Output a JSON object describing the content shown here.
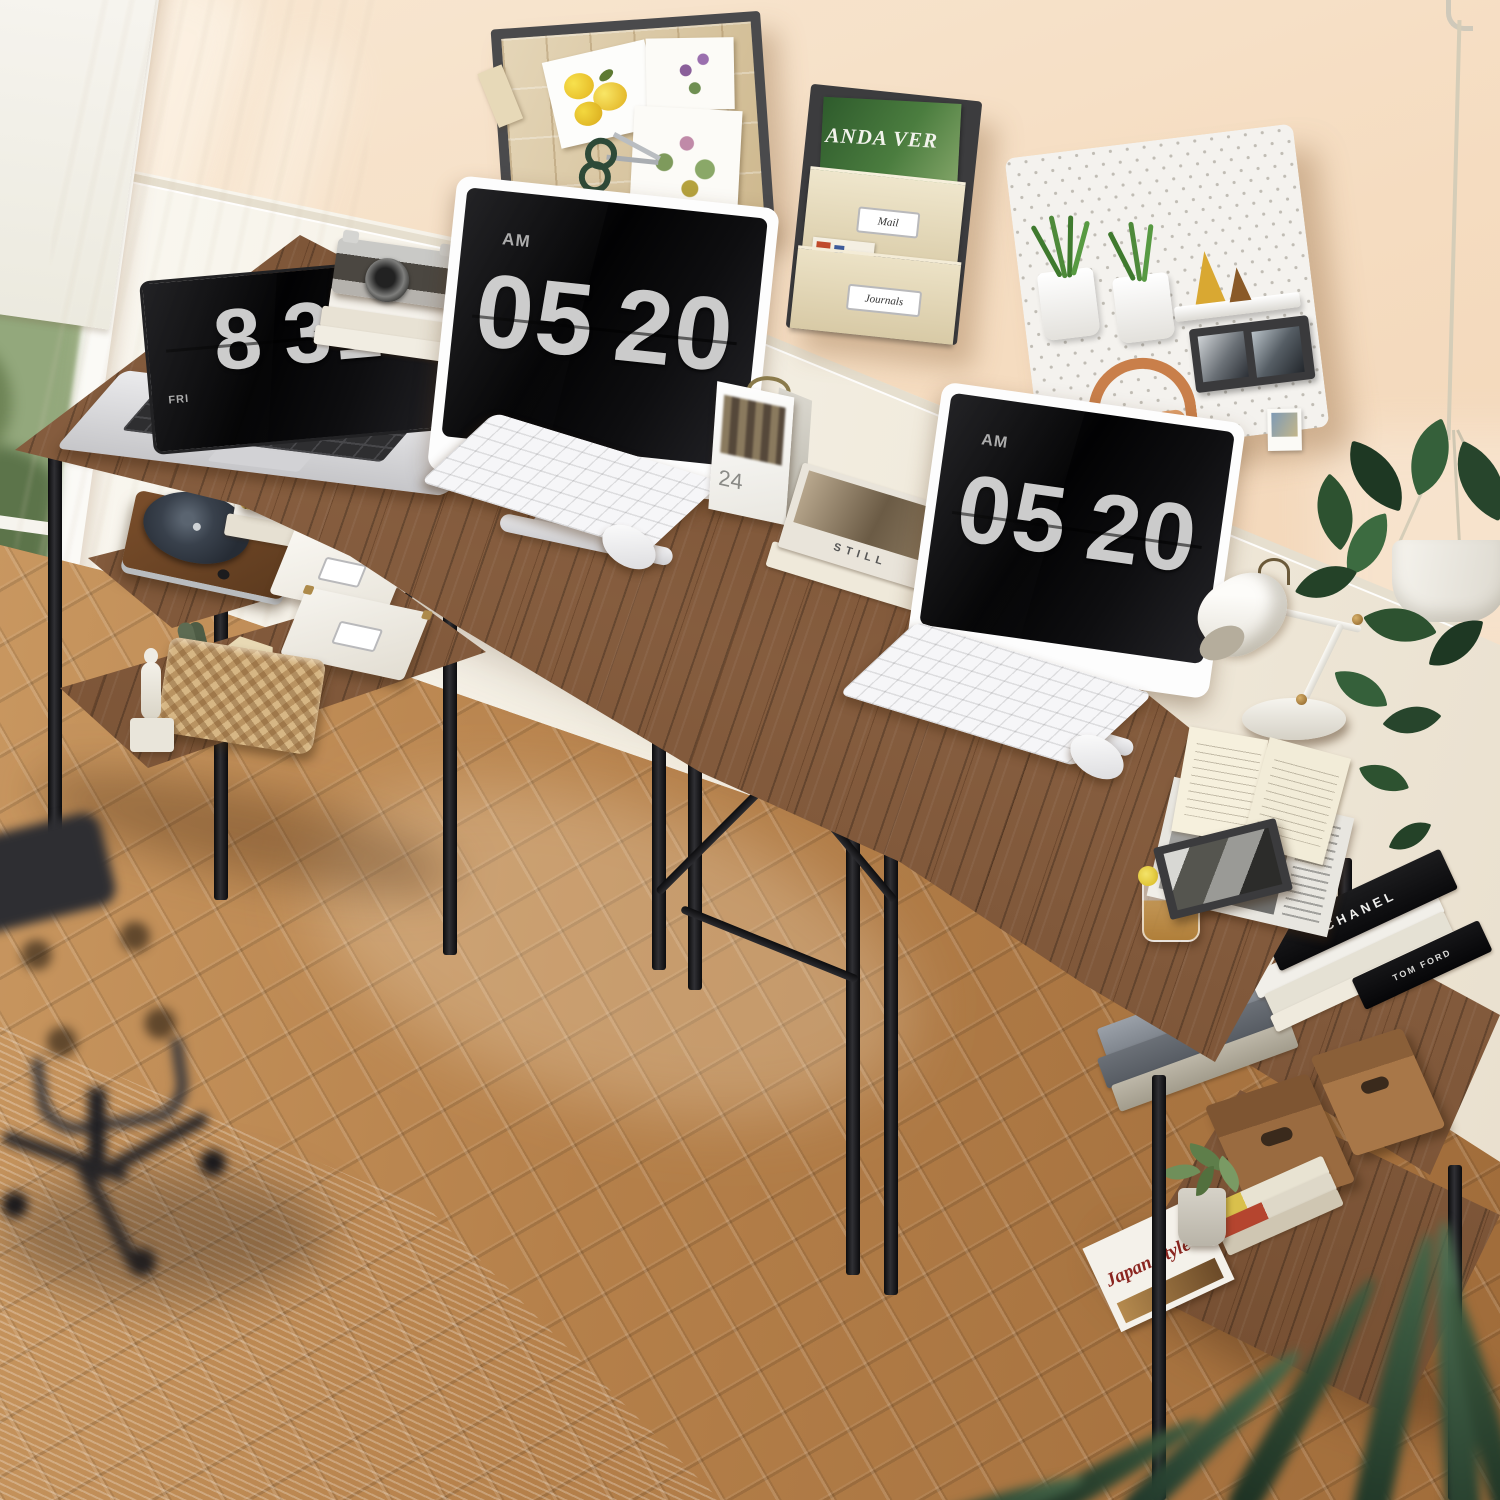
{
  "scene_title": "Rustic brown L-shaped double workstation desk with shelves in sunlit home office",
  "clocks": {
    "laptop": {
      "label": "FRI",
      "hour": "8",
      "minute": "31"
    },
    "monitor_left": {
      "meridiem": "AM",
      "hour": "05",
      "minute": "20"
    },
    "monitor_right": {
      "meridiem": "AM",
      "hour": "05",
      "minute": "20"
    }
  },
  "calendar": {
    "day": "24"
  },
  "wall_organizer": {
    "magazine_title": "ANDA VER",
    "pocket_labels": [
      "Mail",
      "Journals"
    ]
  },
  "books": {
    "desk_book_spine": "STILL",
    "shelf_black_spine": "CHANEL",
    "shelf_black_edge": "TOM FORD",
    "bottom_magazine_title": "Japan Style"
  },
  "palette": {
    "wall": "#f5dcc0",
    "trim": "#f6f3ec",
    "floor": "#b8834c",
    "desk_wood": "#7b4f2e",
    "desk_edge_light": "#d9af6e",
    "metal_frame": "#17171a",
    "rug": "#dcd4c6",
    "plant_green": "#2f5233",
    "headphones_orange": "#c97f4a",
    "magazine_green": "#3e6b33"
  }
}
